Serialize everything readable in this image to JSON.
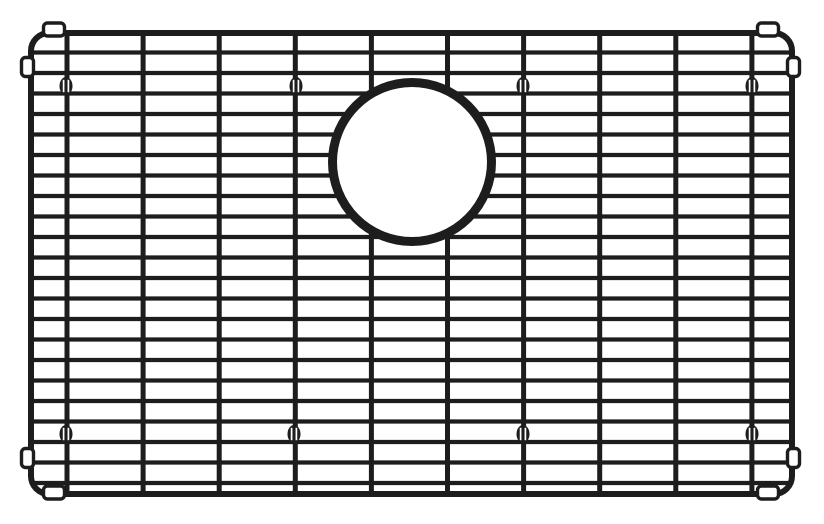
{
  "diagram": {
    "name": "sink-bottom-grid-line-drawing",
    "description": "Black line drawing of a rectangular wire sink grid with rounded corners, a circular drain cutout at upper center, four corner bumper pairs and eight oval feet",
    "canvas": {
      "width": 824,
      "height": 524
    },
    "colors": {
      "background": "#ffffff",
      "ink": "#1d1d1d"
    },
    "frame": {
      "x": 31,
      "y": 33,
      "width": 761,
      "height": 461,
      "corner_radius": 18,
      "stroke_width": 6
    },
    "horizontal_wires": {
      "count": 22,
      "first_y": 52.5,
      "spacing": 20.5,
      "x1": 31,
      "x2": 792,
      "stroke_width": 4.3
    },
    "vertical_wires": {
      "count": 10,
      "first_x": 67,
      "spacing": 76.1,
      "y1": 33,
      "y2": 493.5,
      "stroke_width": 5
    },
    "drain_cutout": {
      "cx": 412,
      "cy": 162,
      "radius": 79.5,
      "ring_stroke_width": 9
    },
    "feet": {
      "rx": 6.5,
      "ry": 9,
      "slit_offset": 2.4,
      "slit_half_height": 6.2,
      "slit_stroke_width": 1.7,
      "positions": [
        [
          66,
          86
        ],
        [
          296,
          86
        ],
        [
          523,
          86
        ],
        [
          752,
          86
        ],
        [
          66,
          434
        ],
        [
          294,
          434
        ],
        [
          523,
          434
        ],
        [
          752,
          434
        ]
      ]
    },
    "bumpers": {
      "stroke_width": 3.4,
      "corner_radius": 4,
      "horizontal": {
        "width": 21,
        "height": 13,
        "centers": [
          [
            54,
            29.5
          ],
          [
            768,
            29.5
          ],
          [
            54,
            492.5
          ],
          [
            768,
            492.5
          ]
        ]
      },
      "vertical": {
        "width": 12,
        "height": 19,
        "centers": [
          [
            27.5,
            67
          ],
          [
            793.5,
            67
          ],
          [
            27.5,
            458
          ],
          [
            793.5,
            458
          ]
        ]
      }
    }
  }
}
